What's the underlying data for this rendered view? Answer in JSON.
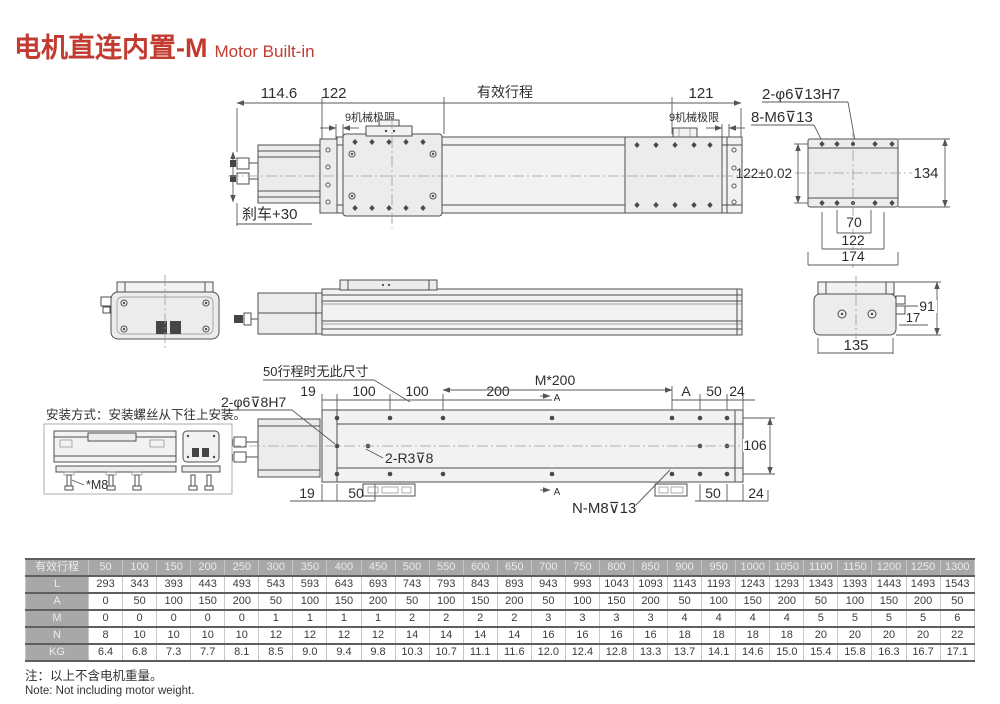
{
  "title": {
    "cn": "电机直连内置-M",
    "en": "Motor Built-in"
  },
  "colors": {
    "accent": "#c23b31",
    "line": "#4f4f4f",
    "table_header_bg": "#a8a8a8"
  },
  "top_view": {
    "dim_motor": "114.6",
    "dim_carriage": "122",
    "dim_stroke": "有效行程",
    "dim_right": "121",
    "mech_limit_left": "9机械极限",
    "mech_limit_right": "9机械极限",
    "brake": "刹车+30"
  },
  "end_view": {
    "label_dowel": "2-φ6⊽13H7",
    "label_thread": "8-M6⊽13",
    "dim_width_tol": "122±0.02",
    "dim_height": "134",
    "dim_70": "70",
    "dim_122": "122",
    "dim_174": "174"
  },
  "side_view": {
    "dim_17": "17",
    "dim_91": "91",
    "dim_135": "135"
  },
  "bottom_view": {
    "note_stroke50": "50行程时无此尺寸",
    "label_dowel": "2-φ6⊽8H7",
    "label_r3": "2-R3⊽8",
    "label_n": "N-M8⊽13",
    "dim_19_top": "19",
    "dim_100_1": "100",
    "dim_100_2": "100",
    "dim_200": "200",
    "dim_m200": "M*200",
    "dim_a": "A",
    "dim_50_top": "50",
    "dim_24_top": "24",
    "dim_106": "106",
    "dim_19_bot": "19",
    "dim_50_botleft": "50",
    "dim_50_botright": "50",
    "dim_24_bot": "24",
    "section_a_top": "A",
    "section_a_bot": "A"
  },
  "install": {
    "caption": "安装方式：安装螺丝从下往上安装。",
    "screw_label": "*M8"
  },
  "table": {
    "header_label": "有效行程",
    "strokes": [
      "50",
      "100",
      "150",
      "200",
      "250",
      "300",
      "350",
      "400",
      "450",
      "500",
      "550",
      "600",
      "650",
      "700",
      "750",
      "800",
      "850",
      "900",
      "950",
      "1000",
      "1050",
      "1100",
      "1150",
      "1200",
      "1250",
      "1300"
    ],
    "rows": [
      {
        "label": "L",
        "values": [
          "293",
          "343",
          "393",
          "443",
          "493",
          "543",
          "593",
          "643",
          "693",
          "743",
          "793",
          "843",
          "893",
          "943",
          "993",
          "1043",
          "1093",
          "1143",
          "1193",
          "1243",
          "1293",
          "1343",
          "1393",
          "1443",
          "1493",
          "1543"
        ]
      },
      {
        "label": "A",
        "values": [
          "0",
          "50",
          "100",
          "150",
          "200",
          "50",
          "100",
          "150",
          "200",
          "50",
          "100",
          "150",
          "200",
          "50",
          "100",
          "150",
          "200",
          "50",
          "100",
          "150",
          "200",
          "50",
          "100",
          "150",
          "200",
          "50"
        ]
      },
      {
        "label": "M",
        "values": [
          "0",
          "0",
          "0",
          "0",
          "0",
          "1",
          "1",
          "1",
          "1",
          "2",
          "2",
          "2",
          "2",
          "3",
          "3",
          "3",
          "3",
          "4",
          "4",
          "4",
          "4",
          "5",
          "5",
          "5",
          "5",
          "6"
        ]
      },
      {
        "label": "N",
        "values": [
          "8",
          "10",
          "10",
          "10",
          "10",
          "12",
          "12",
          "12",
          "12",
          "14",
          "14",
          "14",
          "14",
          "16",
          "16",
          "16",
          "16",
          "18",
          "18",
          "18",
          "18",
          "20",
          "20",
          "20",
          "20",
          "22"
        ]
      },
      {
        "label": "KG",
        "values": [
          "6.4",
          "6.8",
          "7.3",
          "7.7",
          "8.1",
          "8.5",
          "9.0",
          "9.4",
          "9.8",
          "10.3",
          "10.7",
          "11.1",
          "11.6",
          "12.0",
          "12.4",
          "12.8",
          "13.3",
          "13.7",
          "14.1",
          "14.6",
          "15.0",
          "15.4",
          "15.8",
          "16.3",
          "16.7",
          "17.1"
        ]
      }
    ]
  },
  "footer": {
    "note_cn": "注：以上不含电机重量。",
    "note_en": "Note: Not including motor weight."
  }
}
